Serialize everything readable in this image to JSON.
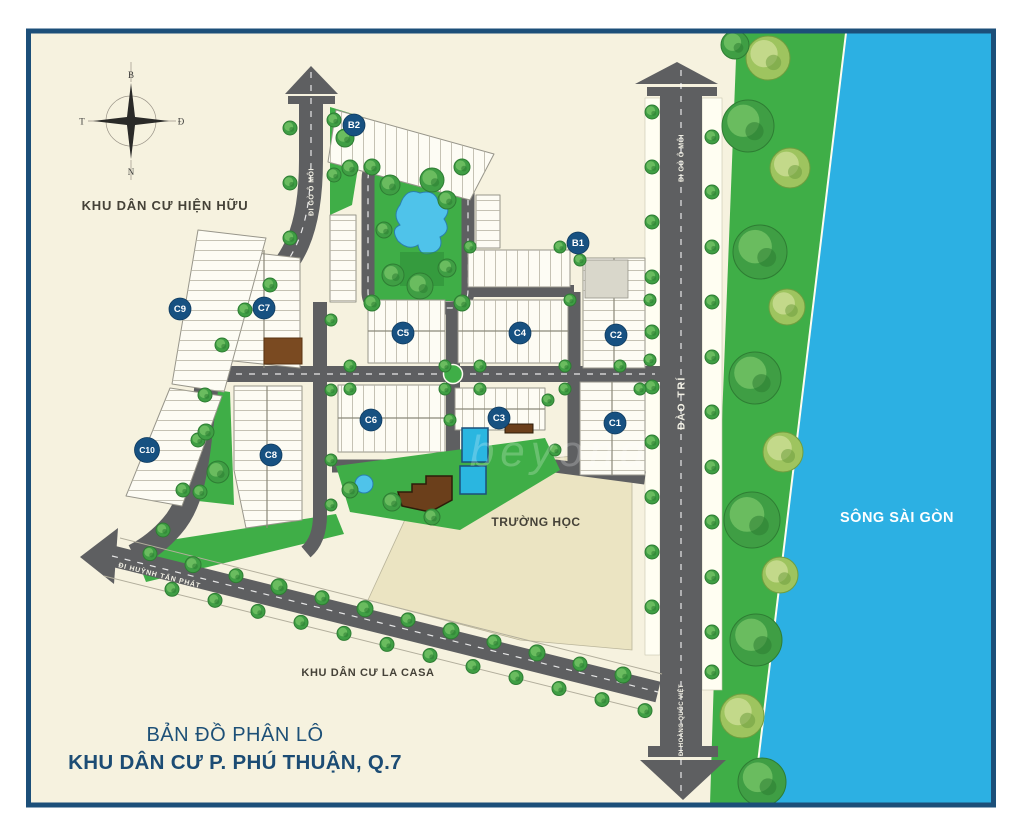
{
  "title": {
    "line1": "BẢN ĐỒ PHÂN LÔ",
    "line2": "KHU DÂN CƯ P. PHÚ THUẬN, Q.7"
  },
  "labels": {
    "existing_area": "KHU DÂN CƯ HIỆN HỮU",
    "la_casa": "KHU DÂN CƯ LA CASA",
    "school": "TRƯỜNG HỌC",
    "river": "SÔNG SÀI GÒN",
    "road_go_o_moi_left": "ĐI GÒ Ô MÔI",
    "road_go_o_moi_right": "ĐI GÒ Ô MÔI",
    "road_dao_tri": "ĐÀO TRÍ",
    "road_hoang_quoc_viet": "ĐI HOÀNG QUỐC VIỆT",
    "road_huynh_tan_phat": "ĐI HUỲNH TẤN PHÁT",
    "watermark": "beyond"
  },
  "compass": {
    "north": "B",
    "east": "Đ",
    "south": "N",
    "west": "T"
  },
  "badges": [
    {
      "label": "B2",
      "x": 354,
      "y": 125
    },
    {
      "label": "B1",
      "x": 578,
      "y": 243
    },
    {
      "label": "C2",
      "x": 616,
      "y": 335
    },
    {
      "label": "C5",
      "x": 403,
      "y": 333
    },
    {
      "label": "C4",
      "x": 520,
      "y": 333
    },
    {
      "label": "C6",
      "x": 371,
      "y": 420
    },
    {
      "label": "C3",
      "x": 499,
      "y": 418
    },
    {
      "label": "C1",
      "x": 615,
      "y": 423
    },
    {
      "label": "C9",
      "x": 180,
      "y": 309
    },
    {
      "label": "C7",
      "x": 264,
      "y": 308
    },
    {
      "label": "C10",
      "x": 147,
      "y": 450
    },
    {
      "label": "C8",
      "x": 271,
      "y": 455
    }
  ],
  "colors": {
    "badge": "#175181",
    "water": "#2cb0e3",
    "green": "#3fae47",
    "park_dark": "#2e8c36",
    "road": "#5e5f61",
    "cream": "#f6f2df",
    "school": "#ebe4c2",
    "frame": "#1c4f79",
    "title": "#1d4e78",
    "label": "#454238",
    "lake": "#4fc3ea",
    "pool": "#2ab6e0",
    "building_brown": "#7a4a21"
  }
}
